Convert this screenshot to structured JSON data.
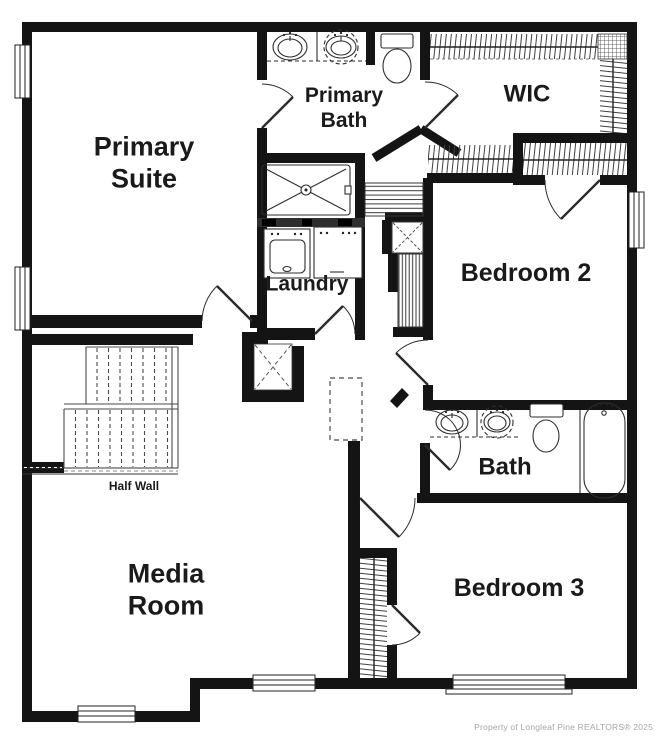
{
  "plan": {
    "rooms": {
      "primary_suite": {
        "label": "Primary\nSuite"
      },
      "primary_bath": {
        "label": "Primary\nBath"
      },
      "wic": {
        "label": "WIC"
      },
      "bedroom_2": {
        "label": "Bedroom 2"
      },
      "laundry": {
        "label": "Laundry"
      },
      "bath": {
        "label": "Bath"
      },
      "media_room": {
        "label": "Media\nRoom"
      },
      "bedroom_3": {
        "label": "Bedroom 3"
      }
    },
    "annotations": {
      "half_wall": "Half Wall"
    },
    "fixtures": [
      "vanity-double-sink-icon",
      "toilet-icon",
      "walk-in-shower-icon",
      "bathtub-icon",
      "washer-icon",
      "dryer-icon",
      "staircase",
      "closet-rod-hatch",
      "linen-closet-x",
      "attic-access-panel",
      "window-symbol",
      "door-swing"
    ],
    "footer": {
      "copyright": "Property of Longleaf Pine REALTORS®  2025"
    }
  },
  "colors": {
    "wall": "#141414",
    "line": "#2e2e2e",
    "hatch": "#3f3f3f",
    "label": "#1a1a1a",
    "copyright": "#a6a6a6",
    "background": "#ffffff"
  }
}
